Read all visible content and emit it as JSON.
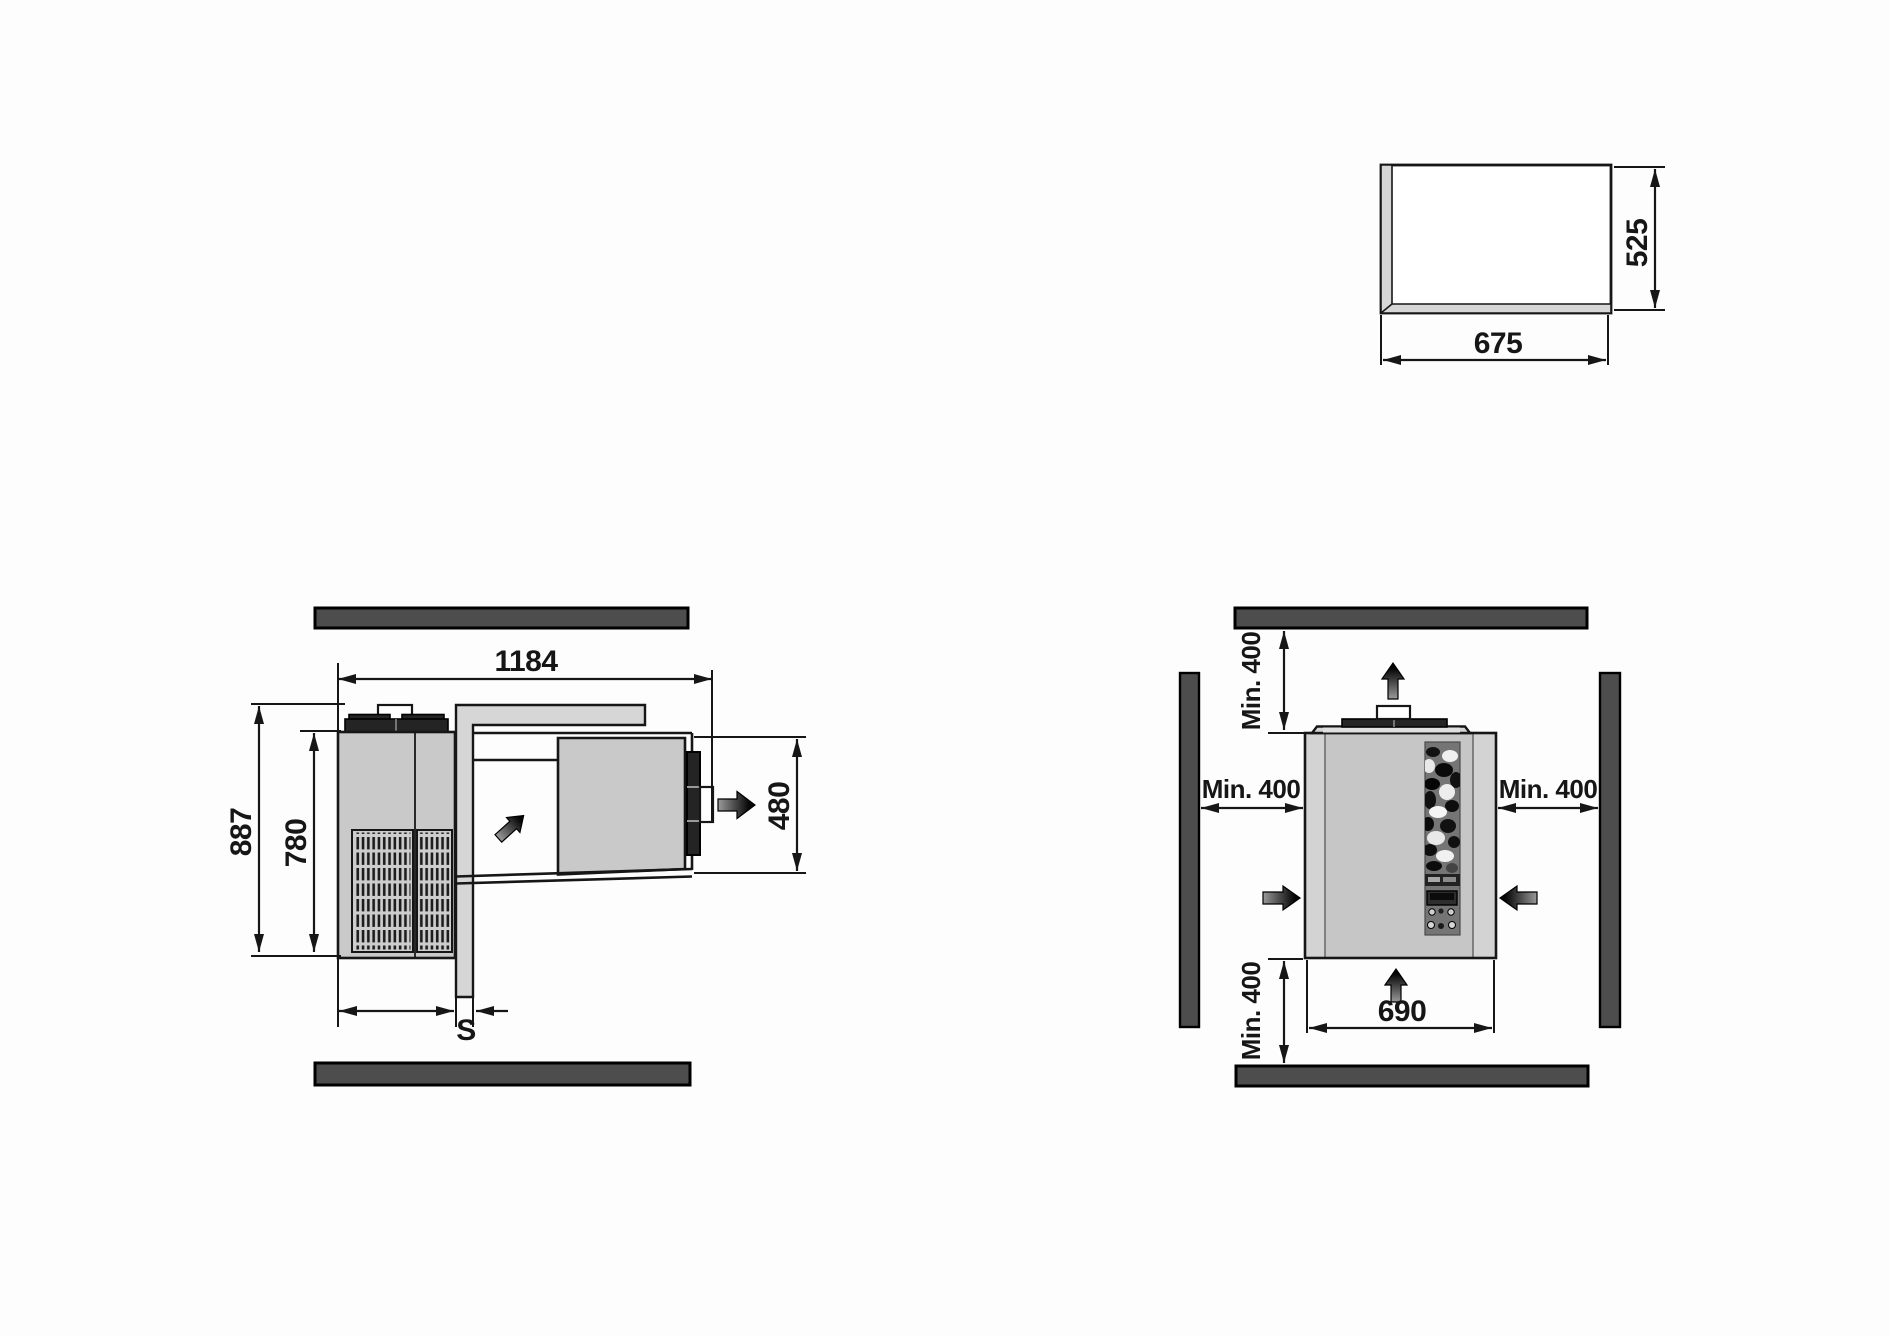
{
  "title": "Monoblock refrigeration unit installation drawing",
  "side_view": {
    "overall_width": "1184",
    "overall_height": "887",
    "housing_height": "780",
    "indoor_section_height": "480",
    "outdoor_section_depth": "430",
    "wall_thickness": "S"
  },
  "front_view": {
    "clearance_top": "Min. 400",
    "clearance_left": "Min. 400",
    "clearance_right": "Min. 400",
    "clearance_bottom": "Min. 400",
    "unit_width": "690"
  },
  "cutout_view": {
    "cutout_width": "675",
    "cutout_height": "525"
  },
  "icons": [
    "airflow-arrow-up",
    "airflow-arrow-in-left",
    "airflow-arrow-in-right",
    "airflow-arrow-in-bottom",
    "airflow-arrow-out-right",
    "airflow-arrow-diagonal"
  ],
  "colors": {
    "line": "#161616",
    "wall_bar": "#4d4d4d",
    "unit_gray": "#c9c9c9",
    "panel_gray": "#d6d6d6",
    "cap_dark": "#242424",
    "background": "#fdfdfd"
  }
}
